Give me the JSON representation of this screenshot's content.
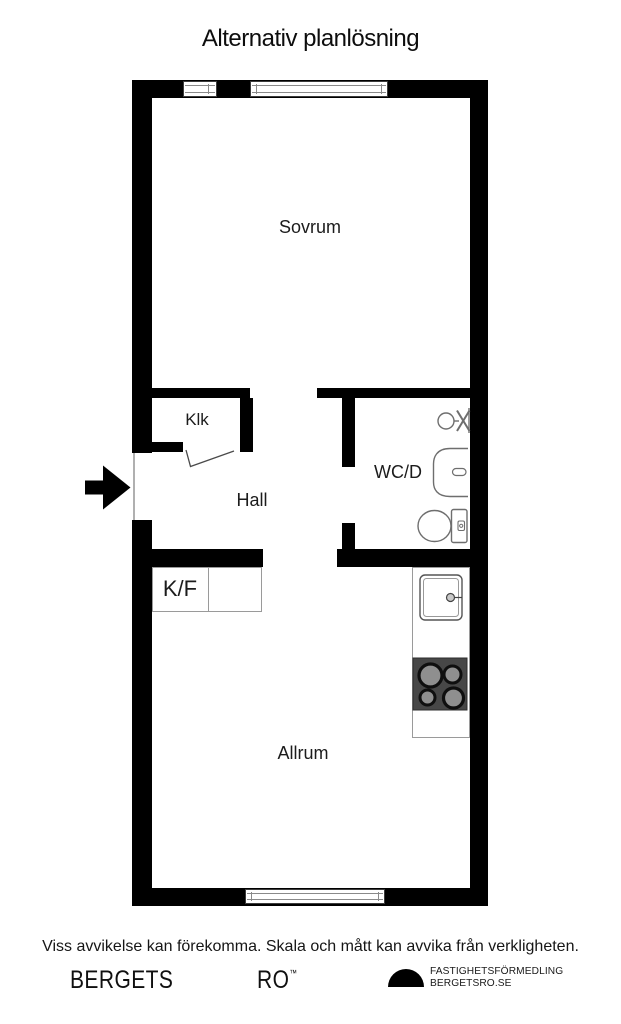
{
  "title": "Alternativ planlösning",
  "rooms": {
    "sovrum": "Sovrum",
    "klk": "Klk",
    "hall": "Hall",
    "wcd": "WC/D",
    "kf": "K/F",
    "allrum": "Allrum"
  },
  "fixtures": {
    "entrance": "entrance-arrow",
    "bathroom": [
      "faucet-valve",
      "washbasin",
      "toilet"
    ],
    "kitchen": [
      "kitchen-sink",
      "stove-4-burners",
      "counter",
      "fridge-freezer-cabinets"
    ],
    "windows": [
      "top-small",
      "top-large",
      "bottom"
    ]
  },
  "footer": {
    "disclaimer": "Viss avvikelse kan förekomma. Skala och mått kan avvika från verkligheten.",
    "brand_left": "BERGETS",
    "brand_right": "RO",
    "trademark": "™",
    "agency_line1": "FASTIGHETSFÖRMEDLING",
    "agency_line2": "BERGETSRO.SE"
  },
  "colors": {
    "wall": "#000000",
    "background": "#ffffff",
    "fixture_outline": "#6e6e6e",
    "stove_body": "#474747",
    "burner_fill": "#8f8f8f",
    "text": "#111111"
  }
}
